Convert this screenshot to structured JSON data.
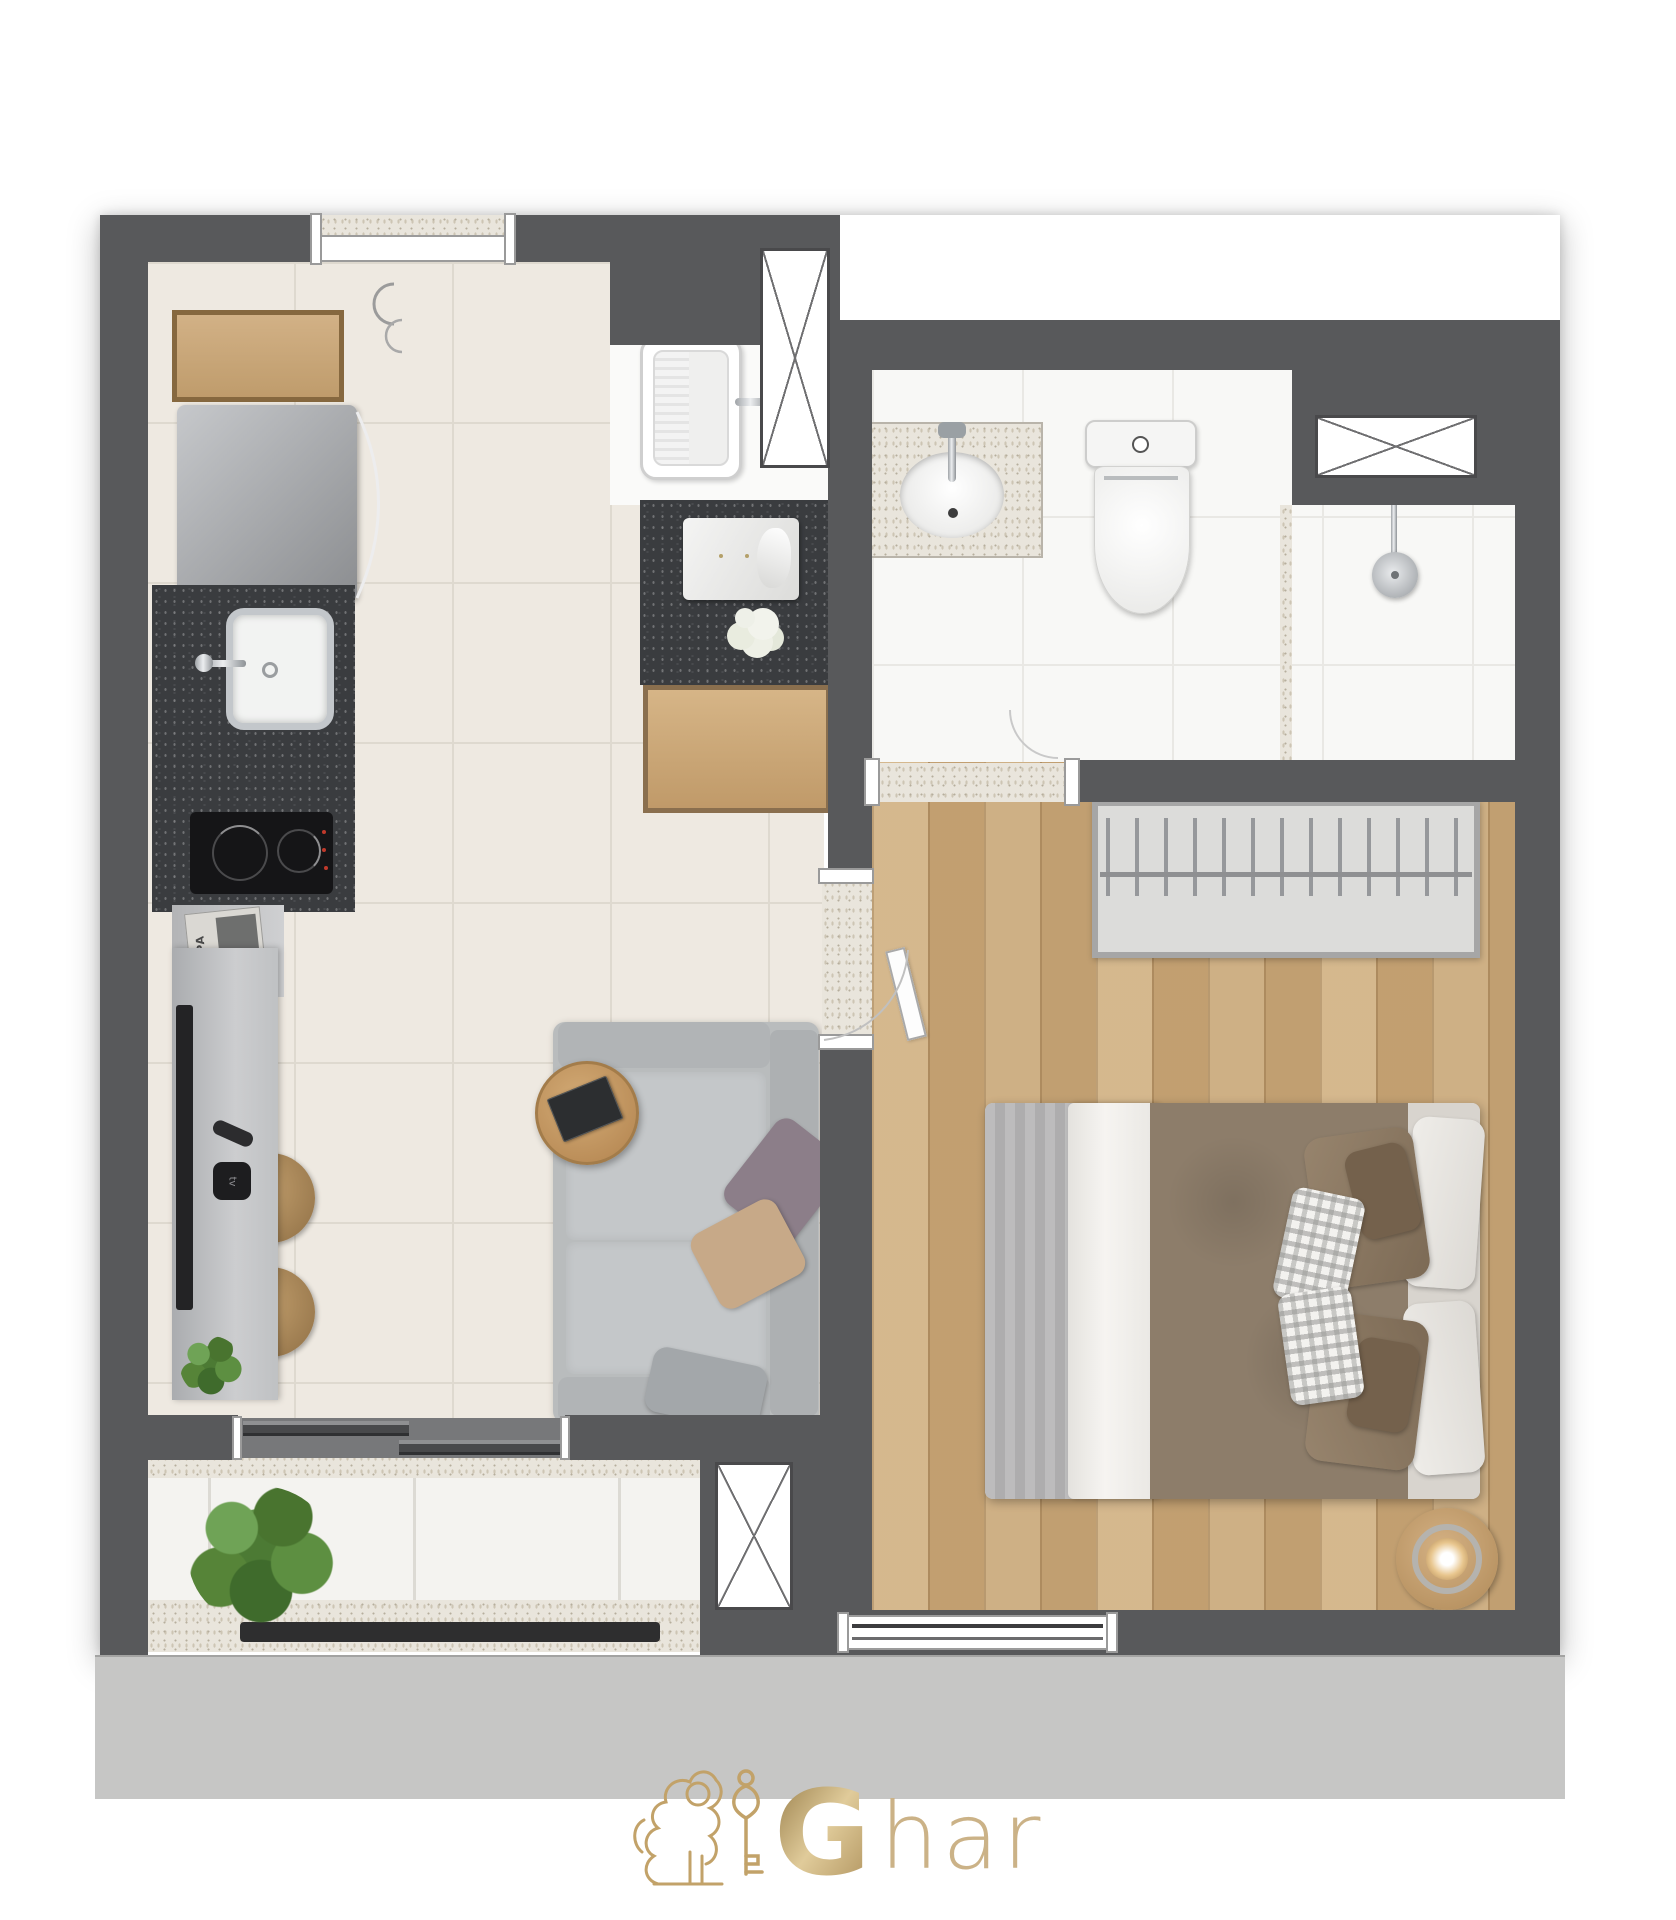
{
  "page": {
    "type": "apartment-floor-plan-top-view-render",
    "background": "#ffffff"
  },
  "logo": {
    "name": "Ghar",
    "text_g": "G",
    "text_rest": "har",
    "gold": "#c5a76f",
    "mark": "lion-holding-key"
  },
  "texts": {
    "magazine": "SCARPA",
    "media_player": "tv"
  },
  "palette": {
    "wall": "#58595b",
    "living_floor": "#eee9e1",
    "wood_floor": "#c9a87a",
    "bath_floor": "#f8f8f6",
    "balcony_floor": "#f4f3f0",
    "granite": "#3a3c3f",
    "terrazzo": "#e9e5dc",
    "apron": "#c6c6c5",
    "sofa": "#bcbfc1",
    "duvet_brown": "#8d7d6a",
    "blanket_gray": "#b6b5b6",
    "gold": "#c5a76f"
  },
  "rooms": [
    {
      "id": "kitchen-living"
    },
    {
      "id": "bathroom"
    },
    {
      "id": "bedroom"
    },
    {
      "id": "balcony"
    },
    {
      "id": "laundry-niche"
    }
  ],
  "fixtures": [
    "upper-wood-cabinet",
    "refrigerator",
    "kitchen-sink",
    "induction-cooktop",
    "magazine-shelf",
    "tv-sideboard",
    "television",
    "remote-control",
    "media-player",
    "round-stool",
    "round-stool",
    "small-plant",
    "sofa",
    "coffee-table",
    "book",
    "laundry-tub",
    "service-counter",
    "folded-shirt",
    "flowers",
    "wood-cabinet",
    "vanity-sink",
    "toilet",
    "shower",
    "ventilation-shaft",
    "ventilation-shaft",
    "ventilation-shaft",
    "wardrobe-rack",
    "bedroom-tv",
    "double-bed",
    "pillows",
    "bedside-lamp-table",
    "balcony-plant",
    "sliding-door",
    "window",
    "window"
  ]
}
